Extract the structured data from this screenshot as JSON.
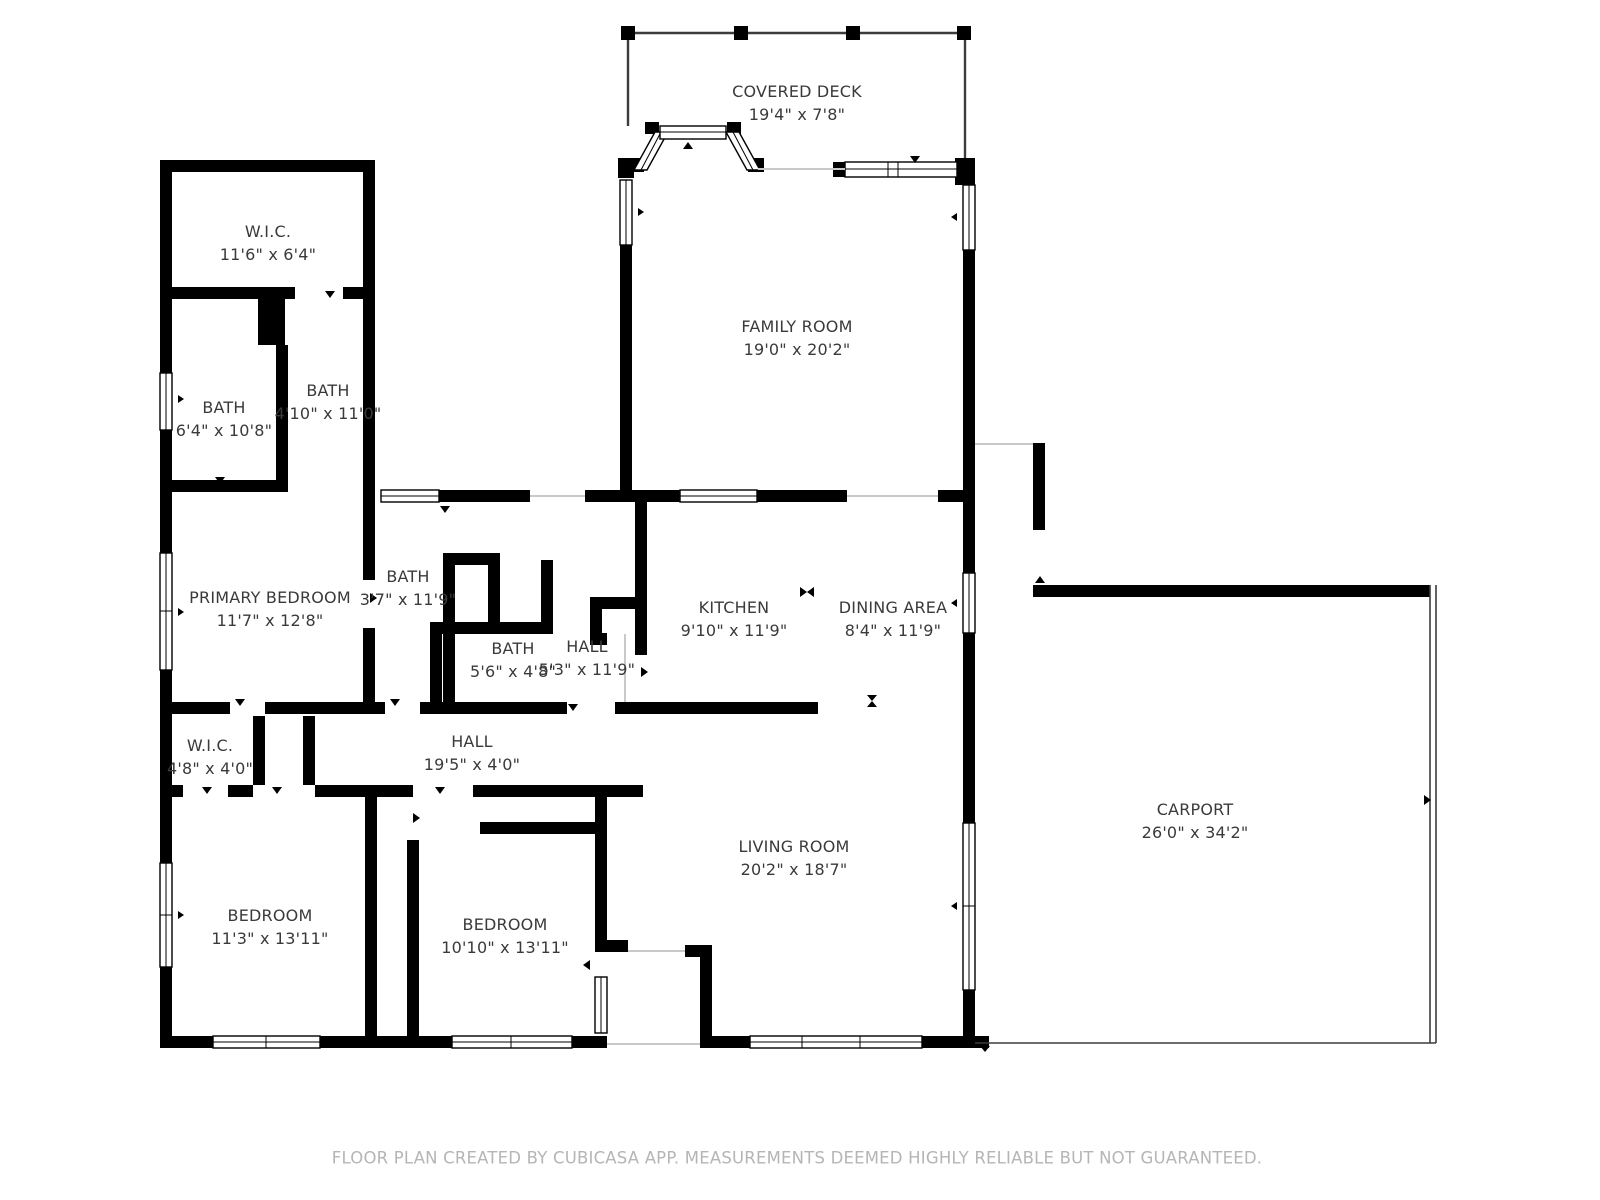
{
  "title": "Floor plan",
  "colors": {
    "wall": "#000000",
    "deck_outline": "#3c3c3c",
    "opening_line": "#c9c9c9",
    "label_text": "#3a3a3a",
    "footer_text": "#b5b5b5",
    "background": "#ffffff"
  },
  "rooms": [
    {
      "name": "COVERED DECK",
      "dims": "19'4\" x 7'8\""
    },
    {
      "name": "W.I.C.",
      "dims": "11'6\" x 6'4\""
    },
    {
      "name": "FAMILY ROOM",
      "dims": "19'0\" x 20'2\""
    },
    {
      "name": "BATH",
      "dims": "6'4\" x 10'8\""
    },
    {
      "name": "BATH",
      "dims": "4'10\" x 11'0\""
    },
    {
      "name": "PRIMARY BEDROOM",
      "dims": "11'7\" x 12'8\""
    },
    {
      "name": "BATH",
      "dims": "3'7\" x 11'9\""
    },
    {
      "name": "BATH",
      "dims": "5'6\" x 4'8\""
    },
    {
      "name": "HALL",
      "dims": "5'3\" x 11'9\""
    },
    {
      "name": "KITCHEN",
      "dims": "9'10\" x 11'9\""
    },
    {
      "name": "DINING AREA",
      "dims": "8'4\" x 11'9\""
    },
    {
      "name": "W.I.C.",
      "dims": "4'8\" x 4'0\""
    },
    {
      "name": "HALL",
      "dims": "19'5\" x 4'0\""
    },
    {
      "name": "BEDROOM",
      "dims": "11'3\" x 13'11\""
    },
    {
      "name": "BEDROOM",
      "dims": "10'10\" x 13'11\""
    },
    {
      "name": "LIVING ROOM",
      "dims": "20'2\" x 18'7\""
    },
    {
      "name": "CARPORT",
      "dims": "26'0\" x 34'2\""
    }
  ],
  "footer": {
    "text": "FLOOR PLAN CREATED BY CUBICASA APP. MEASUREMENTS DEEMED HIGHLY RELIABLE BUT NOT GUARANTEED."
  }
}
